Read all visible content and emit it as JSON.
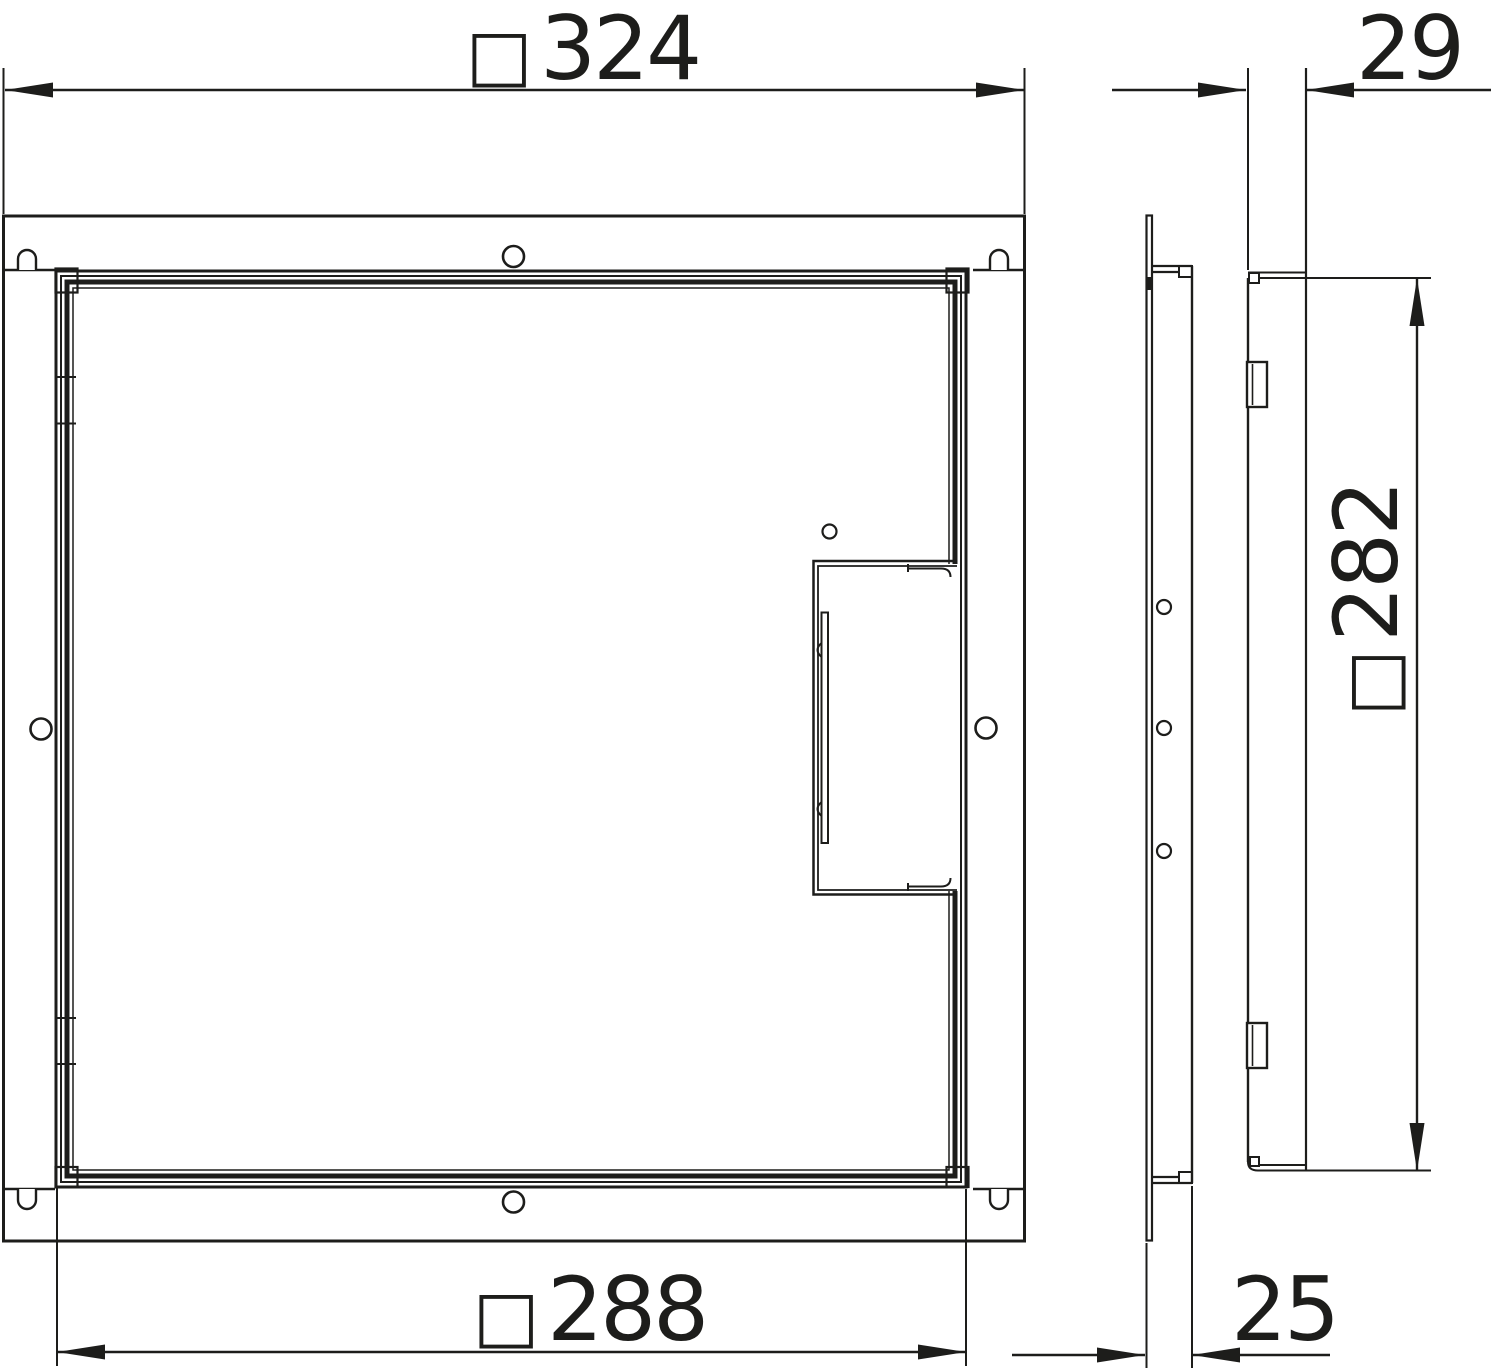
{
  "drawing": {
    "background": "#ffffff",
    "line_color": "#1d1d1b",
    "description_labels": {
      "square_symbol": "□"
    },
    "dimensions": {
      "outer_width": {
        "prefix": "□",
        "value": "324"
      },
      "total_depth": {
        "prefix": "",
        "value": "29"
      },
      "inner_width": {
        "prefix": "□",
        "value": "288"
      },
      "frame_depth": {
        "prefix": "",
        "value": "25"
      },
      "inner_height": {
        "prefix": "□",
        "value": "282"
      }
    }
  }
}
